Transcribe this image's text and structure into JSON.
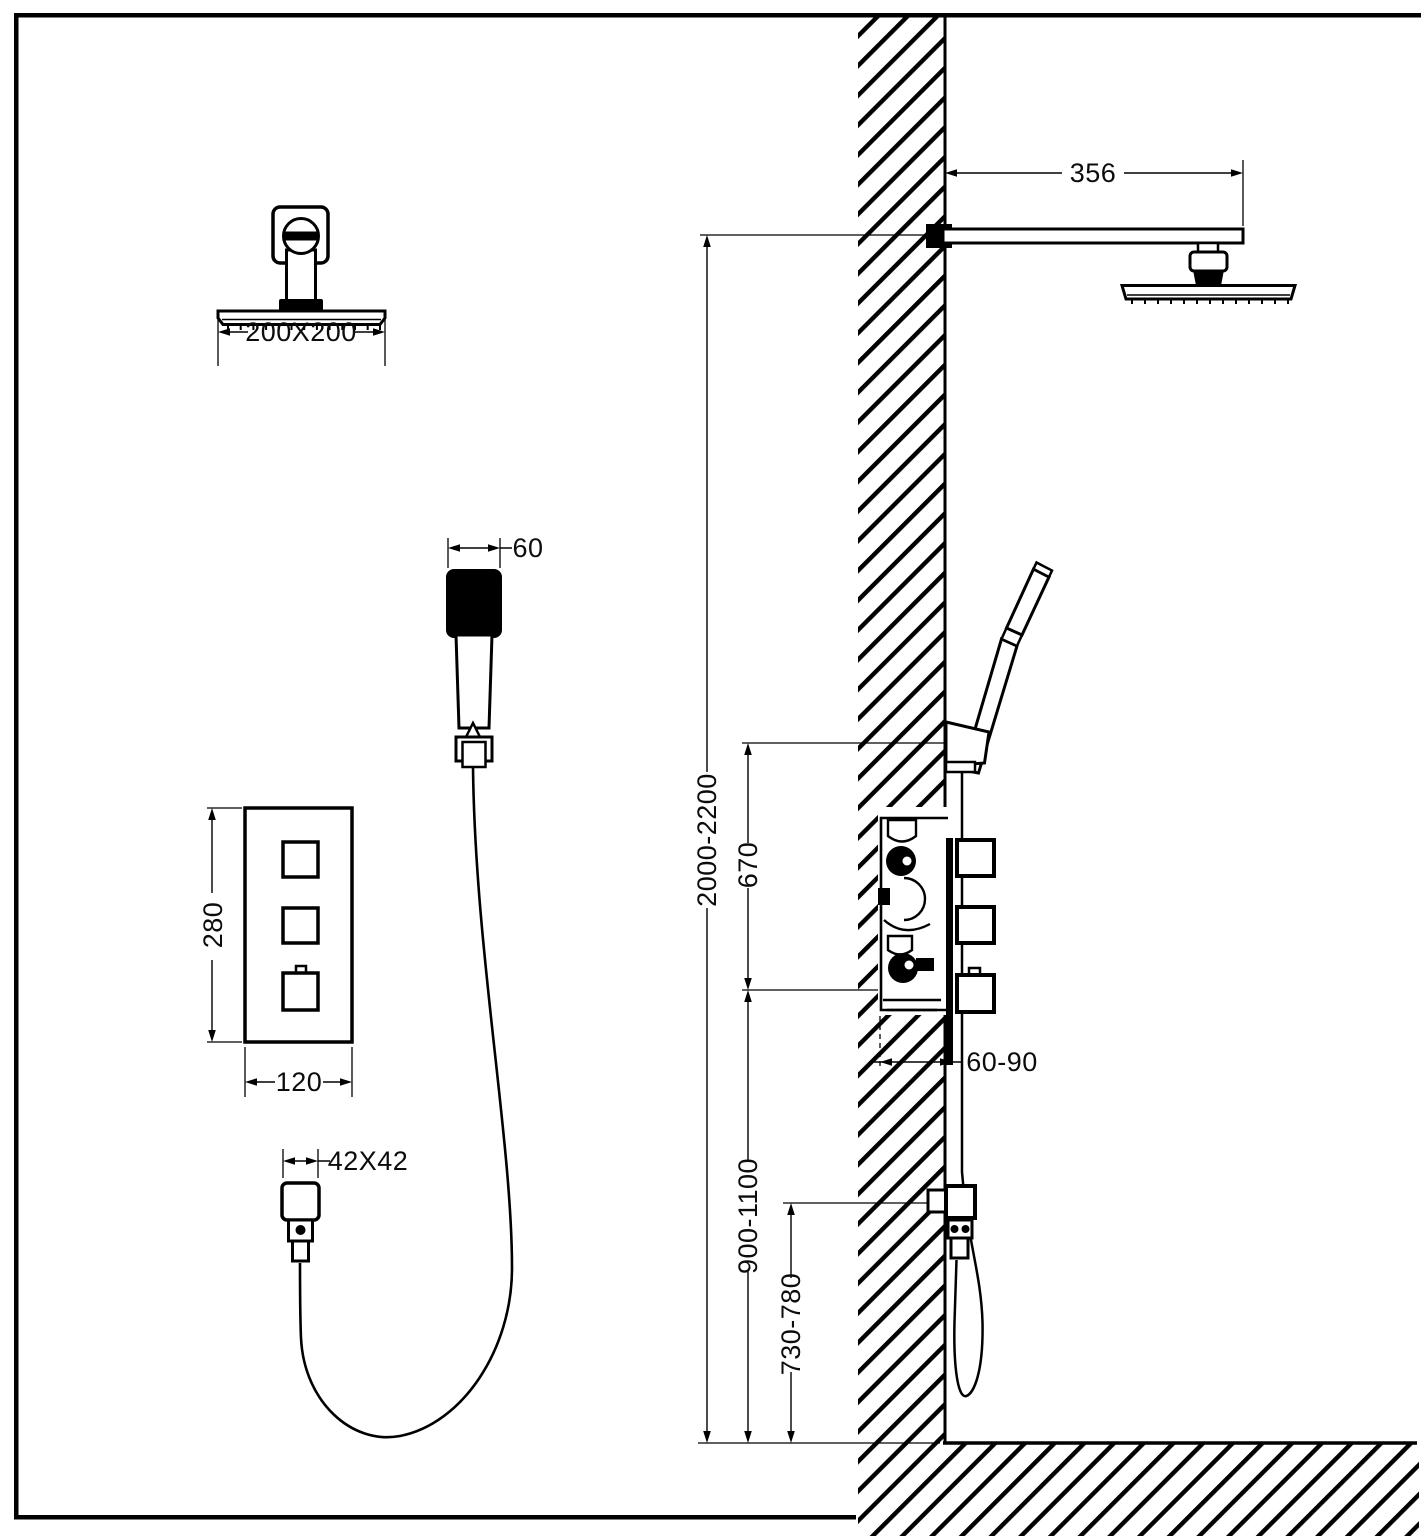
{
  "drawing": {
    "background_color": "#ffffff",
    "line_color": "#000000",
    "views": {
      "front": {
        "shower_head_dim": "200X200",
        "hand_shower_dim": "60",
        "mixer_panel_height_dim": "280",
        "mixer_panel_width_dim": "120",
        "wall_outlet_dim": "42X42"
      },
      "side": {
        "arm_length_dim": "356",
        "overall_height_dim": "2000-2200",
        "holder_to_mixer_dim": "670",
        "embed_depth_dim": "60-90",
        "mixer_height_dim": "900-1100",
        "outlet_height_dim": "730-780"
      }
    }
  }
}
